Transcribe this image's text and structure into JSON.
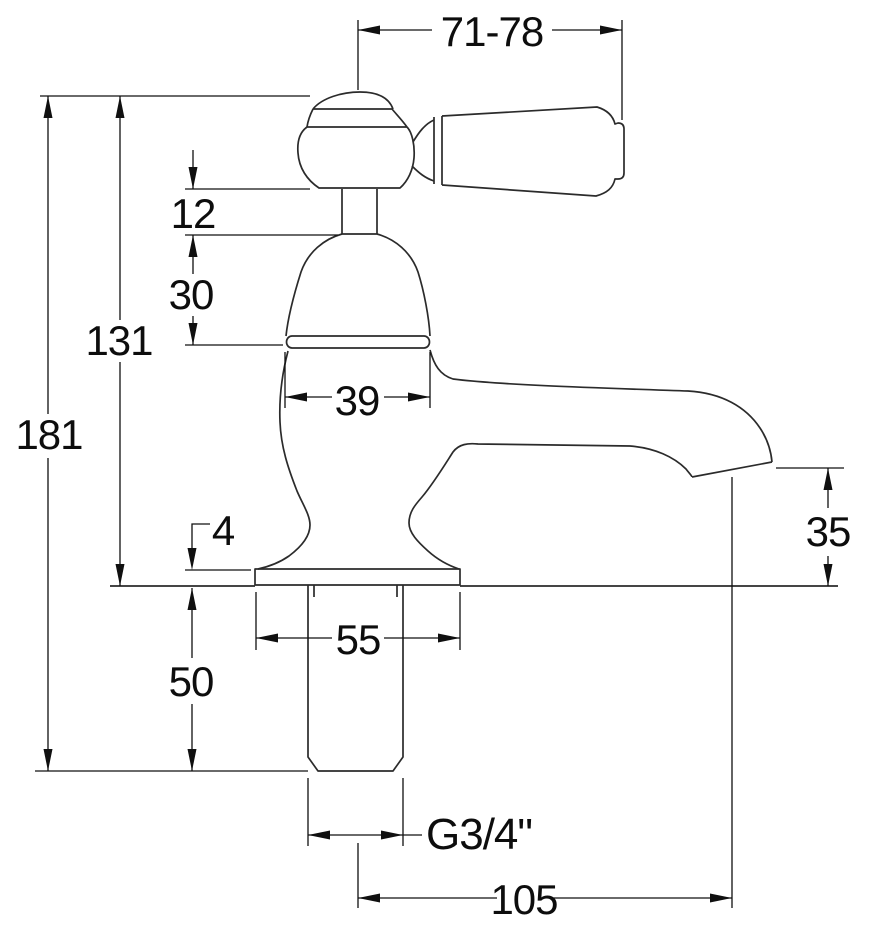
{
  "drawing": {
    "background": "#ffffff",
    "line_color": "#2b2b2b",
    "dim_color": "#101010",
    "dims": {
      "handle_span": "71-78",
      "collar_height": "12",
      "bonnet_height": "30",
      "deck_to_top": "131",
      "overall_height": "181",
      "bonnet_width": "39",
      "base_plate_thickness": "4",
      "spout_clearance": "35",
      "base_width": "55",
      "tail_length": "50",
      "thread_size": "G3/4\"",
      "spout_reach": "105"
    }
  }
}
